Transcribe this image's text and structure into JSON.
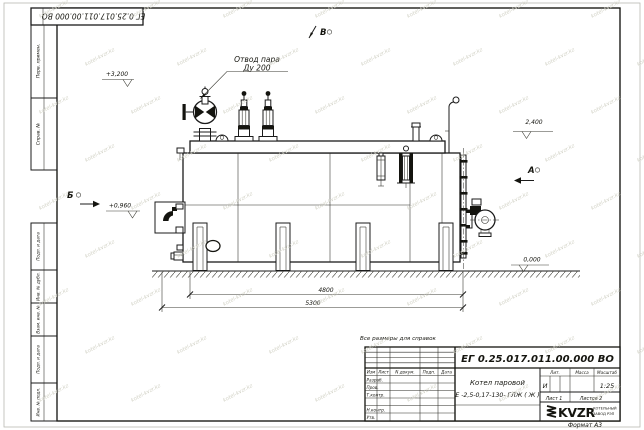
{
  "sheet": {
    "doc_number_top": "ЕГ 0.25.017.011.00.000  ВО",
    "note": "Все размеры для справок",
    "format_label": "Формат А3"
  },
  "watermark": {
    "text": "kotel-kvzr.kz"
  },
  "side_column": {
    "cell_1": "Перв. примен.",
    "cell_2": "Справ. №",
    "cell_3": "Подп. и дата",
    "cell_4": "Инв. № дубл.",
    "cell_5": "Взам. инв. №",
    "cell_6": "Подп. и дата",
    "cell_7": "Инв. № подл."
  },
  "drawing": {
    "callout": {
      "line1": "Отвод пара",
      "line2": "Ду 200"
    },
    "views": {
      "a": "А",
      "b": "Б",
      "v": "В"
    },
    "elevations": {
      "top": "+3,200",
      "burner": "+0,960",
      "right": "2,400",
      "ground": "0,000"
    },
    "dimensions": {
      "shell_length": "4800",
      "total_length": "5300"
    }
  },
  "title_block": {
    "doc_number": "ЕГ 0.25.017.011.00.000  ВО",
    "product_name": "Котел паровой",
    "product_model": "Е -2,5-0,17-130- ГЛЖ ( Ж )",
    "columns": {
      "izm": "Изм",
      "list": "Лист",
      "doc": "N докум.",
      "podp": "Подп.",
      "data": "Дата"
    },
    "rows": {
      "razrab": "Разраб.",
      "prov": "Пров.",
      "tkontr": "Т.контр.",
      "nkontr": "Н.контр.",
      "utv": "Утв."
    },
    "lit_label": "Лит.",
    "mass_label": "Масса",
    "scale_label": "Масштаб",
    "lit_value": "И",
    "scale_value": "1:25",
    "sheet_info": "Лист 1",
    "sheets_info": "Листов 2",
    "logo": {
      "name": "KVZR",
      "sub1": "КОТЕЛЬНЫЙ",
      "sub2": "ЗАВОД РЭП"
    }
  }
}
